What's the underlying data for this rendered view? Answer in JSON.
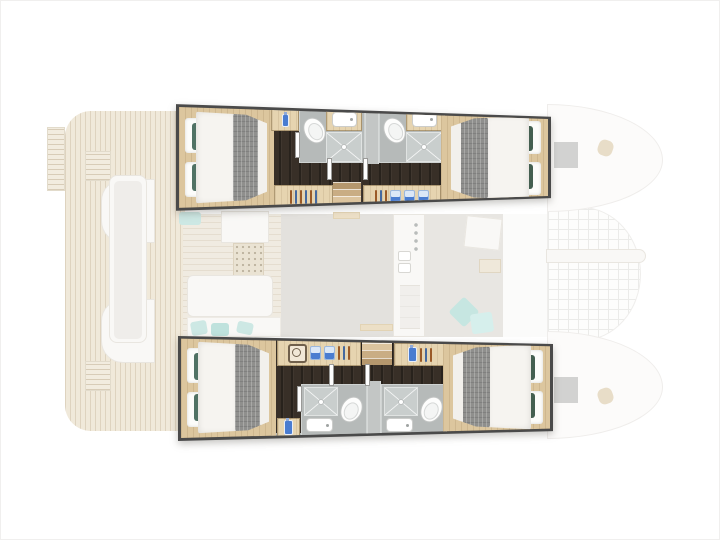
{
  "page": {
    "type": "yacht-floor-plan",
    "vessel": "catamaran",
    "view": "top-down interior layout, bow to the right",
    "highlighted": "both hulls: 4 double cabins and 4 bathrooms",
    "text_labels": []
  },
  "colors": {
    "outline": "#4a4a4a",
    "wenge": "#382f27",
    "oak": "#dcc69e",
    "bath": "#b6bab9",
    "shower": "#c9cecd",
    "duvet": "#f6f4f0",
    "blanket": "#8f8f8d",
    "pilgreen": "#445f50",
    "pilteal": "#507264",
    "blue": "#4a7cd0",
    "teak": "#f0e9da",
    "ghostgray": "#e3e1dd",
    "teal": "#cde8e4"
  },
  "hulls": [
    {
      "id": "port-hull",
      "position": "top",
      "cabins": [
        {
          "id": "port-aft-cabin",
          "bed": "double",
          "head_end": "aft (left)",
          "accent_pillows": "teal-green",
          "blanket": "grey runner at foot"
        },
        {
          "id": "port-forward-cabin",
          "bed": "double",
          "head_end": "forward (right)",
          "accent_pillows": "dark-green",
          "blanket": "grey runner at foot"
        }
      ],
      "bathrooms": [
        {
          "id": "port-aft-bathroom",
          "fixtures": [
            "toilet",
            "sink-vanity",
            "shower"
          ]
        },
        {
          "id": "port-forward-bathroom",
          "fixtures": [
            "toilet",
            "sink-vanity",
            "shower"
          ]
        }
      ],
      "features": [
        "wardrobe-with-hangers",
        "companionway-stairs",
        "storage-cabinet-bottles",
        "storage-cabinet-glasses"
      ]
    },
    {
      "id": "starboard-hull",
      "position": "bottom",
      "cabins": [
        {
          "id": "starboard-aft-cabin",
          "bed": "double",
          "head_end": "aft (left)",
          "accent_pillows": "teal-green",
          "blanket": "grey runner at foot"
        },
        {
          "id": "starboard-forward-cabin",
          "bed": "double",
          "head_end": "forward (right)",
          "accent_pillows": "dark-green",
          "blanket": "grey runner at foot"
        }
      ],
      "bathrooms": [
        {
          "id": "starboard-aft-bathroom",
          "fixtures": [
            "shower",
            "sink",
            "toilet"
          ]
        },
        {
          "id": "starboard-forward-bathroom",
          "fixtures": [
            "shower",
            "sink",
            "toilet"
          ]
        }
      ],
      "features": [
        "washing-machine",
        "storage-cabinet-jars",
        "wardrobe-with-hangers",
        "companionway-stairs",
        "storage-cabinet-bottles"
      ]
    }
  ],
  "ghost_areas": [
    "aft-swim-platforms",
    "aft-cockpit-teak-deck",
    "cockpit-bench",
    "cockpit-tables",
    "saloon-floor",
    "chart-table",
    "speaker-panel",
    "saloon-sofa",
    "scatter-cushions",
    "galley-counter",
    "stove",
    "galley-sinks",
    "forward-lounge",
    "lounge-table",
    "forward-deck",
    "trampoline",
    "forward-crossbeam",
    "bow-deck-port",
    "bow-deck-starboard",
    "bow-hatches",
    "bow-cleats"
  ],
  "icons": [
    "toilet-icon",
    "sink-icon",
    "shower-drain-icon",
    "hanger-icon",
    "bottle-icon",
    "glass-icon",
    "jar-icon",
    "washing-machine-icon",
    "stove-knobs-icon"
  ]
}
